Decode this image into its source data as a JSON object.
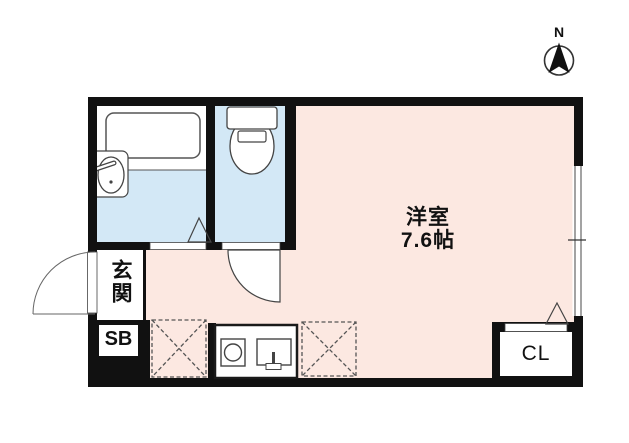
{
  "compass": {
    "north_label": "N"
  },
  "floor_plan": {
    "main_room": {
      "name": "洋室",
      "area": "7.6帖"
    },
    "entrance": {
      "label": "玄関"
    },
    "shoe_box": {
      "label": "SB"
    },
    "closet": {
      "label": "CL"
    }
  },
  "colors": {
    "room_floor": "#fce8e1",
    "wet_area_floor": "#d3e8f6",
    "wall": "#111111",
    "window_frame": "#999999"
  }
}
